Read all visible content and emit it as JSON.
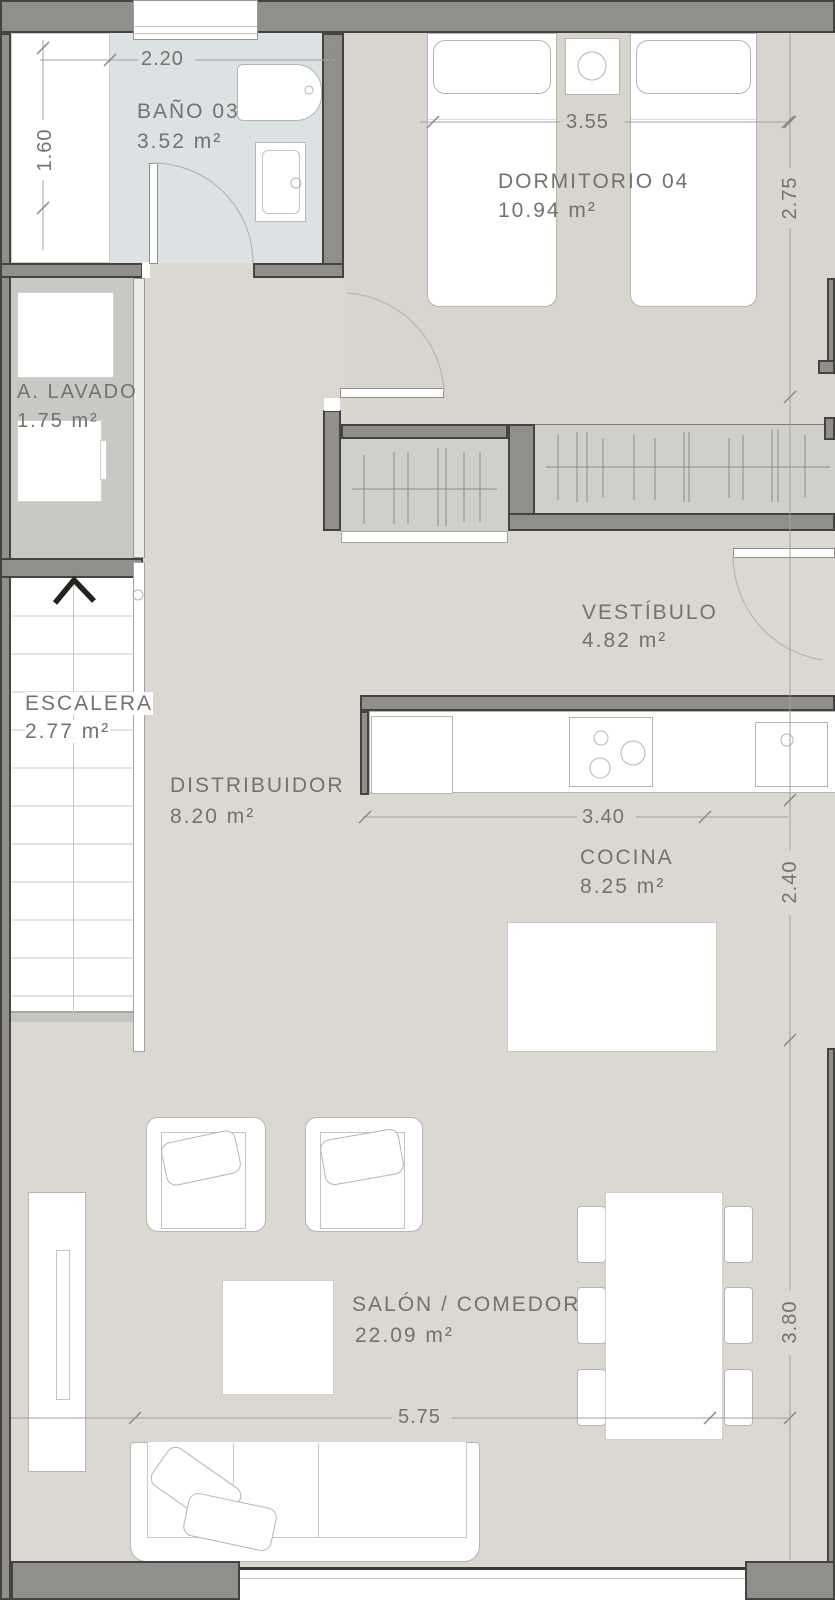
{
  "rooms": [
    {
      "name": "BAÑO 03",
      "area": "3.52 m²"
    },
    {
      "name": "DORMITORIO 04",
      "area": "10.94 m²"
    },
    {
      "name": "A. LAVADO",
      "area": "1.75 m²"
    },
    {
      "name": "ESCALERA",
      "area": "2.77 m²"
    },
    {
      "name": "VESTÍBULO",
      "area": "4.82 m²"
    },
    {
      "name": "DISTRIBUIDOR",
      "area": "8.20 m²"
    },
    {
      "name": "COCINA",
      "area": "8.25 m²"
    },
    {
      "name": "SALÓN / COMEDOR",
      "area": "22.09 m²"
    }
  ],
  "dimensions": [
    {
      "value": "2.20",
      "axis": "horizontal",
      "refers_to": "baño 03 width"
    },
    {
      "value": "1.60",
      "axis": "vertical",
      "refers_to": "left bay height"
    },
    {
      "value": "3.55",
      "axis": "horizontal",
      "refers_to": "dormitorio 04 width"
    },
    {
      "value": "2.75",
      "axis": "vertical",
      "refers_to": "dormitorio 04 depth"
    },
    {
      "value": "3.40",
      "axis": "horizontal",
      "refers_to": "cocina width"
    },
    {
      "value": "2.40",
      "axis": "vertical",
      "refers_to": "cocina depth"
    },
    {
      "value": "5.75",
      "axis": "horizontal",
      "refers_to": "salón / comedor width"
    },
    {
      "value": "3.80",
      "axis": "vertical",
      "refers_to": "salón / comedor depth"
    }
  ],
  "colors": {
    "wall": "#908f8c",
    "wall_outline": "#45433f",
    "floor_main": "#dbd8d2",
    "floor_bedroom": "#d8d5ce",
    "floor_bathroom": "#dce1e4",
    "floor_laundry": "#c9c8c4",
    "floor_closet": "#d1cfca",
    "text": "#74726d"
  }
}
